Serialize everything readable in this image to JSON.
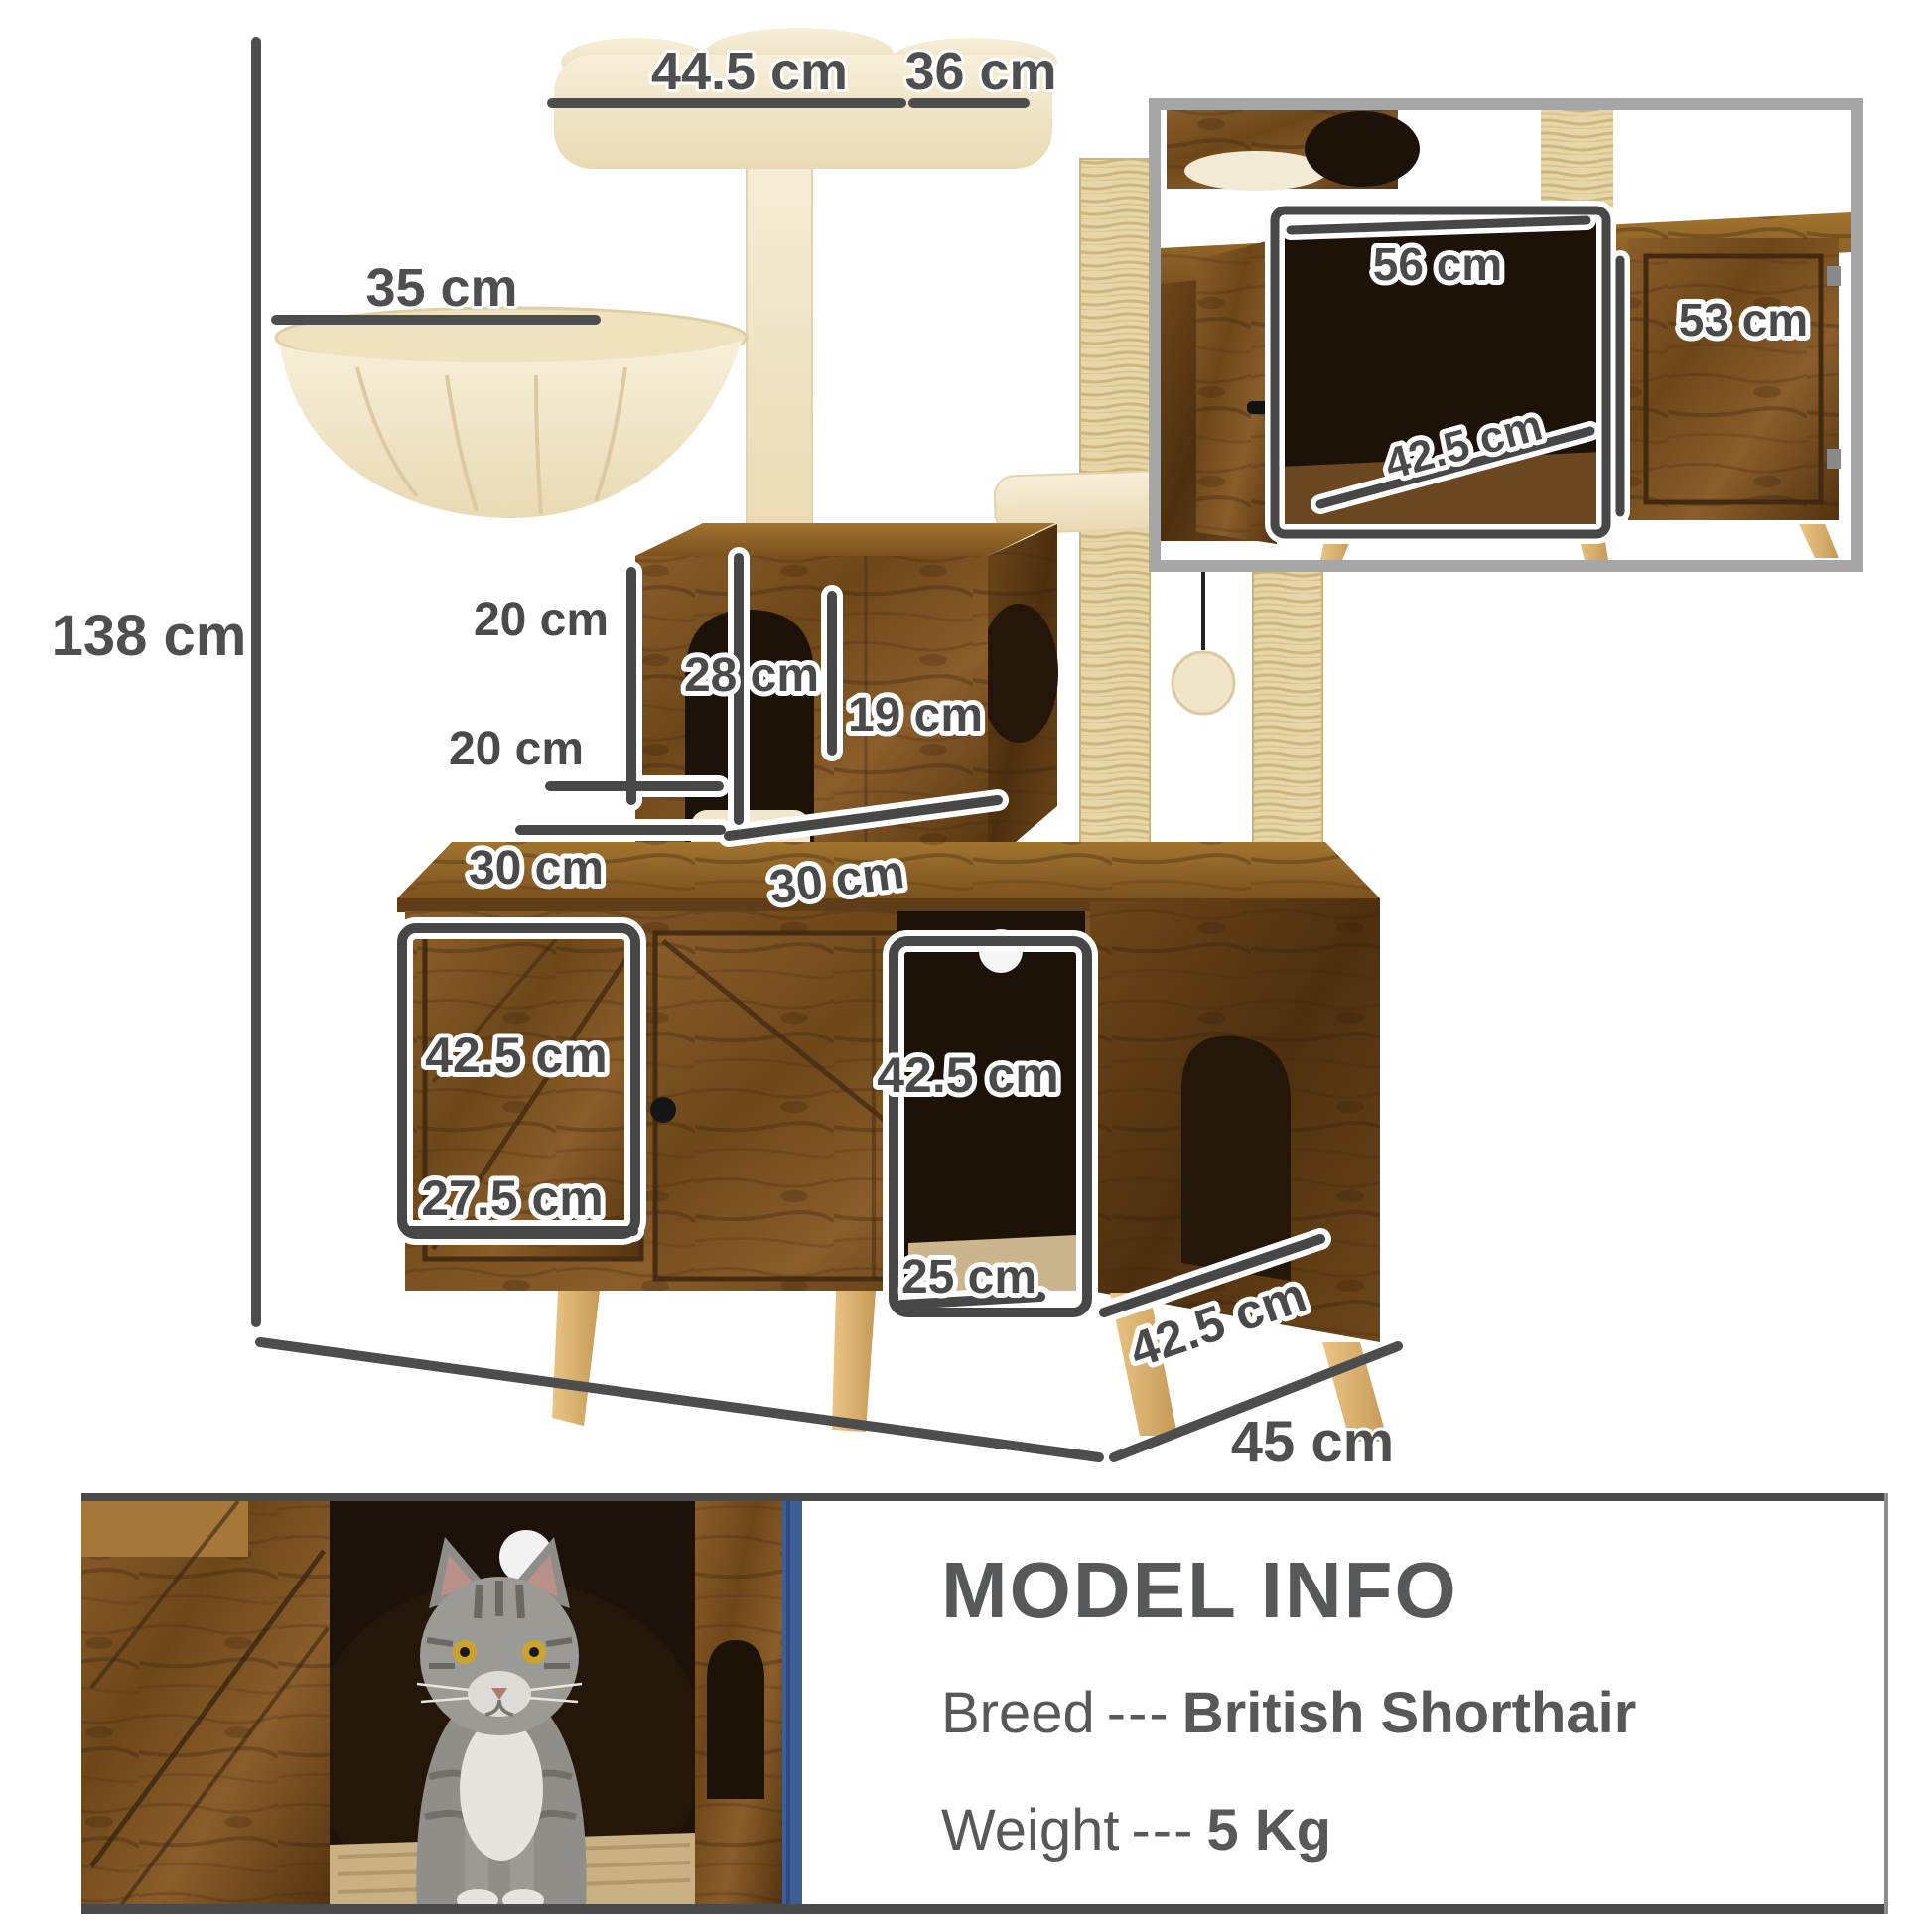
{
  "main_diagram": {
    "annotations": [
      "44.5 cm",
      "36 cm",
      "35 cm",
      "138 cm",
      "20 cm",
      "28 cm",
      "19 cm",
      "20 cm",
      "30 cm",
      "30 cm",
      "42.5 cm",
      "42.5 cm",
      "27.5 cm",
      "25 cm",
      "42.5 cm",
      "85 cm",
      "45 cm"
    ]
  },
  "inset": {
    "annotations": [
      "56 cm",
      "53 cm",
      "42.5 cm"
    ]
  },
  "model_info": {
    "title": "MODEL INFO",
    "breed_label": "Breed",
    "breed_separator": "---",
    "breed_value": "British Shorthair",
    "weight_label": "Weight",
    "weight_separator": "---",
    "weight_value": "5 Kg"
  },
  "colors": {
    "dimension_line": "#4d4d4d",
    "label_text": "#4a4a4a",
    "wood_brown": "#7a5226",
    "plush_cream": "#f4ebd3",
    "sisal": "#e7d6a8",
    "inset_border": "#a6a6a6",
    "info_text": "#57585a",
    "curtain_blue": "#3e5e97"
  }
}
